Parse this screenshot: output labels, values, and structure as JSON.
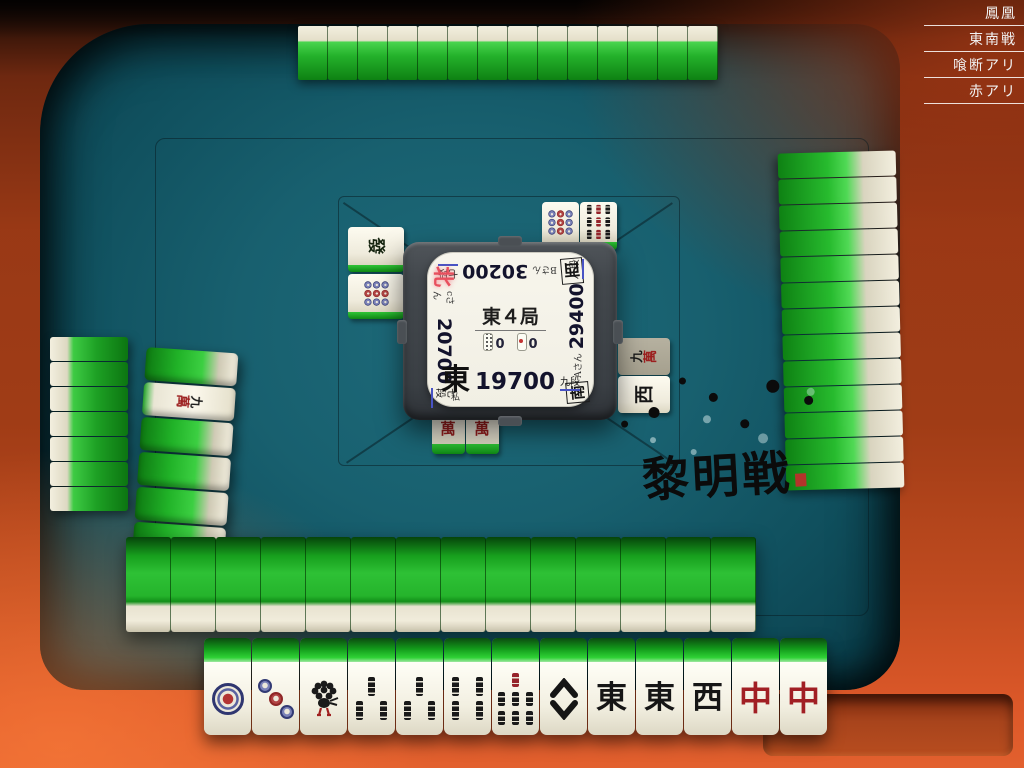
{
  "ruleset": {
    "items": [
      "鳳凰",
      "東南戦",
      "喰断アリ",
      "赤アリ"
    ]
  },
  "center_panel": {
    "round_label": "東４局",
    "counters": {
      "hundred_sticks": "0",
      "riichi_sticks": "0"
    },
    "players": {
      "self": {
        "wind": "東",
        "score": "19700",
        "rank": "九段",
        "name": "私"
      },
      "right": {
        "wind": "南",
        "score": "29400",
        "rank": "八段",
        "name": "Aさん"
      },
      "top": {
        "wind": "西",
        "score": "30200",
        "rank": "七段",
        "name": "Bさん"
      },
      "left": {
        "wind": "北",
        "score": "20700",
        "rank": "七段",
        "name": "cさん"
      }
    }
  },
  "watermark": "黎明戦",
  "hand_tiles": [
    "1p",
    "3p",
    "1s",
    "3s",
    "3s",
    "4s",
    "7s",
    "8s",
    "E",
    "E",
    "W",
    "C",
    "C"
  ],
  "discards": {
    "self": [
      "2m",
      "4m"
    ],
    "left": [
      "hatsu",
      "9p"
    ],
    "top": [
      "9p",
      "9s"
    ],
    "right": [
      "9m",
      "W"
    ]
  },
  "walls": {
    "top_count": 14,
    "right_count": 13,
    "left_count": 7,
    "bottom_count": 14,
    "dead_wall": [
      "back",
      "9m",
      "back",
      "back",
      "back",
      "back",
      "back"
    ]
  },
  "colors": {
    "felt": "#18606f",
    "wood": "#c24c20",
    "tile_green": "#24b22b",
    "rank_underline": "#4853c4",
    "active_wind_red": "#e8505e",
    "dragon_red": "#a11f24"
  }
}
